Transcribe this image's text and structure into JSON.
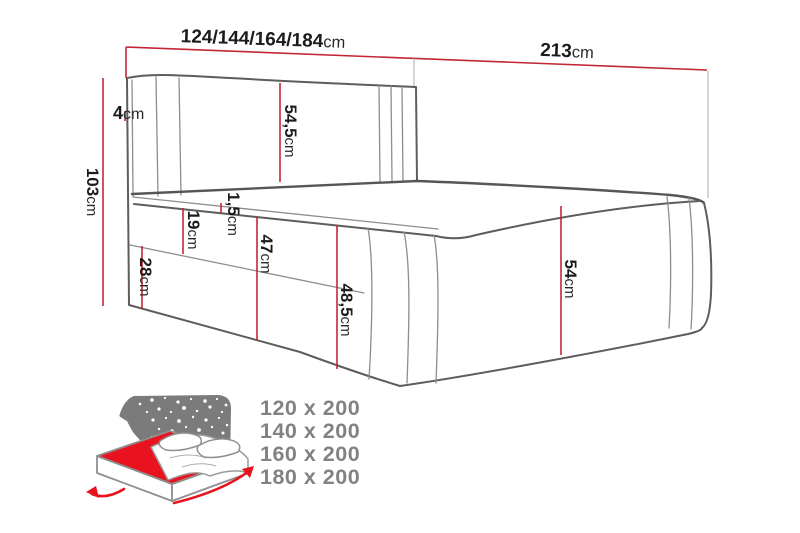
{
  "diagram_title": "bed-dimension-diagram",
  "dimensions": {
    "width_variants": {
      "value": "124/144/164/184",
      "unit": "cm"
    },
    "length": {
      "value": "213",
      "unit": "cm"
    },
    "wing": {
      "value": "4",
      "unit": "cm"
    },
    "total_height": {
      "value": "103",
      "unit": "cm"
    },
    "headboard_above_mattress": {
      "value": "54,5",
      "unit": "cm"
    },
    "mattress_welt": {
      "value": "1,5",
      "unit": "cm"
    },
    "upper_side_section": {
      "value": "19",
      "unit": "cm"
    },
    "lower_side_section": {
      "value": "28",
      "unit": "cm"
    },
    "side_height": {
      "value": "47",
      "unit": "cm"
    },
    "side_height_outer": {
      "value": "48,5",
      "unit": "cm"
    },
    "foot_end_height": {
      "value": "54",
      "unit": "cm"
    }
  },
  "size_options": [
    "120 x 200",
    "140 x 200",
    "160 x 200",
    "180 x 200"
  ],
  "colors": {
    "dimension_red": "#c32733",
    "icon_red": "#e8131f",
    "outline_gray": "#5d5d5d",
    "seam_gray": "#8d8d8d",
    "panel_gray": "#7b7b7b",
    "size_text_gray": "#828282"
  }
}
